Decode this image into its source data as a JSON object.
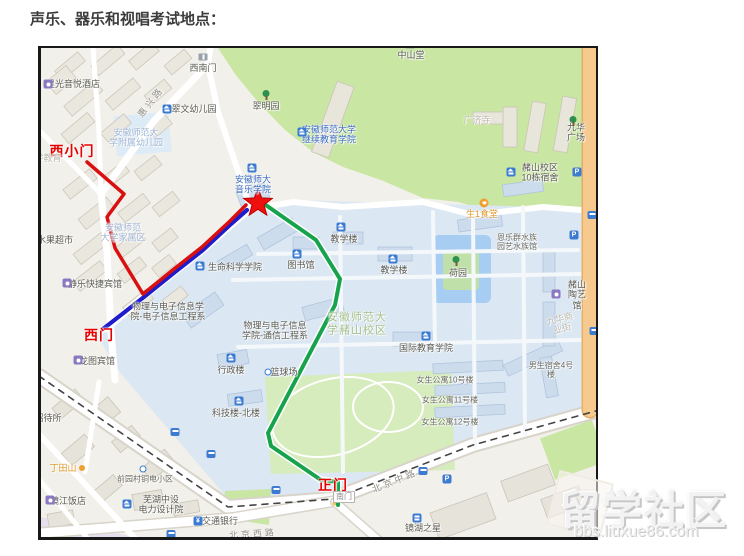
{
  "page": {
    "title": "声乐、器乐和视唱考试地点："
  },
  "watermark": {
    "brand": "留学社区",
    "url": "bbs.liuxue86.com"
  },
  "map": {
    "route_colors": {
      "red": "#da0f0f",
      "blue": "#1f1ccb",
      "green": "#16a34c"
    },
    "star_color": "#ee0f0f",
    "labels": [
      {
        "t": "星光音悦酒店",
        "x": 70,
        "y": 82,
        "c": "poi"
      },
      {
        "t": "西南门",
        "x": 200,
        "y": 66,
        "c": "poi"
      },
      {
        "t": "中山堂",
        "x": 408,
        "y": 53,
        "c": "poi"
      },
      {
        "t": "惠兴路",
        "x": 148,
        "y": 100,
        "c": "road",
        "r": -52
      },
      {
        "t": "翠文幼儿园",
        "x": 191,
        "y": 107,
        "c": "poi"
      },
      {
        "t": "翠明园",
        "x": 263,
        "y": 104,
        "c": "poi"
      },
      {
        "t": "安徽师范大\n学附属幼儿园",
        "x": 133,
        "y": 136,
        "c": "faintblue"
      },
      {
        "t": "西小门",
        "x": 69,
        "y": 149,
        "c": "gate"
      },
      {
        "t": "学教育",
        "x": 45,
        "y": 156,
        "c": "faint"
      },
      {
        "t": "安徽师范大学\n继续教育学院",
        "x": 326,
        "y": 133,
        "c": "blue"
      },
      {
        "t": "广济寺",
        "x": 474,
        "y": 118,
        "c": "faint"
      },
      {
        "t": "九华广场",
        "x": 573,
        "y": 131,
        "c": "poi"
      },
      {
        "t": "安徽师大\n音乐学院",
        "x": 250,
        "y": 183,
        "c": "blue"
      },
      {
        "t": "安徽师范\n大学家属区",
        "x": 120,
        "y": 231,
        "c": "faintblue"
      },
      {
        "t": "水果超市",
        "x": 52,
        "y": 238,
        "c": "poi"
      },
      {
        "t": "生命科学学院",
        "x": 232,
        "y": 265,
        "c": "poi"
      },
      {
        "t": "图书馆",
        "x": 298,
        "y": 263,
        "c": "poi"
      },
      {
        "t": "教学楼",
        "x": 341,
        "y": 237,
        "c": "poi"
      },
      {
        "t": "教学楼",
        "x": 391,
        "y": 268,
        "c": "poi"
      },
      {
        "t": "荷园",
        "x": 455,
        "y": 271,
        "c": "poi"
      },
      {
        "t": "生1食堂",
        "x": 479,
        "y": 212,
        "c": "orange"
      },
      {
        "t": "赭山校区\n10栋宿舍",
        "x": 537,
        "y": 171,
        "c": "poi"
      },
      {
        "t": "恩乐群水族\n园艺水族馆",
        "x": 514,
        "y": 240,
        "c": "poi-small"
      },
      {
        "t": "赭山陶艺馆",
        "x": 574,
        "y": 293,
        "c": "poi"
      },
      {
        "t": "九华商业街",
        "x": 558,
        "y": 322,
        "c": "faint",
        "r": -15
      },
      {
        "t": "静乐快捷宾馆",
        "x": 92,
        "y": 282,
        "c": "poi"
      },
      {
        "t": "物理与电子信息学\n院-电子信息工程系",
        "x": 165,
        "y": 310,
        "c": "poi"
      },
      {
        "t": "物理与电子信息\n学院-通信工程系",
        "x": 272,
        "y": 329,
        "c": "poi"
      },
      {
        "t": "西门",
        "x": 96,
        "y": 333,
        "c": "gate"
      },
      {
        "t": "龙图宾馆",
        "x": 94,
        "y": 359,
        "c": "poi"
      },
      {
        "t": "行政楼",
        "x": 228,
        "y": 368,
        "c": "poi"
      },
      {
        "t": "篮球场",
        "x": 281,
        "y": 370,
        "c": "poi"
      },
      {
        "t": "安徽师范大\n学赭山校区",
        "x": 354,
        "y": 322,
        "c": "faintgreen"
      },
      {
        "t": "国际教育学院",
        "x": 423,
        "y": 346,
        "c": "poi"
      },
      {
        "t": "科技楼-北楼",
        "x": 233,
        "y": 411,
        "c": "poi"
      },
      {
        "t": "女生公寓10号楼",
        "x": 442,
        "y": 378,
        "c": "poi-small"
      },
      {
        "t": "女生公寓11号楼",
        "x": 447,
        "y": 398,
        "c": "poi-small"
      },
      {
        "t": "女生公寓12号楼",
        "x": 447,
        "y": 420,
        "c": "poi-small"
      },
      {
        "t": "男生宿舍4号楼",
        "x": 548,
        "y": 368,
        "c": "poi-small"
      },
      {
        "t": "招待所",
        "x": 45,
        "y": 416,
        "c": "poi"
      },
      {
        "t": "丁田山",
        "x": 60,
        "y": 466,
        "c": "orange"
      },
      {
        "t": "镜江饭店",
        "x": 65,
        "y": 499,
        "c": "poi"
      },
      {
        "t": "前园村铜电小区",
        "x": 142,
        "y": 477,
        "c": "poi-small"
      },
      {
        "t": "芜湖中设\n电力设计院",
        "x": 158,
        "y": 503,
        "c": "poi"
      },
      {
        "t": "交通银行",
        "x": 217,
        "y": 519,
        "c": "poi"
      },
      {
        "t": "北京西路",
        "x": 250,
        "y": 532,
        "c": "road",
        "r": -4
      },
      {
        "t": "正门",
        "x": 330,
        "y": 483,
        "c": "gate"
      },
      {
        "t": "南门",
        "x": 341,
        "y": 495,
        "c": "box"
      },
      {
        "t": "北京中路",
        "x": 392,
        "y": 479,
        "c": "road",
        "r": -22
      },
      {
        "t": "镜湖之星",
        "x": 420,
        "y": 526,
        "c": "poi"
      }
    ],
    "icons": [
      {
        "k": "hotel-icon",
        "x": 45,
        "y": 82
      },
      {
        "k": "gate-icon",
        "x": 200,
        "y": 55
      },
      {
        "k": "gate-icon",
        "x": 407,
        "y": 43
      },
      {
        "k": "school-icon",
        "x": 164,
        "y": 107
      },
      {
        "k": "tree-icon",
        "x": 263,
        "y": 93
      },
      {
        "k": "school-icon",
        "x": 299,
        "y": 130
      },
      {
        "k": "tree-icon",
        "x": 570,
        "y": 119
      },
      {
        "k": "school-icon",
        "x": 249,
        "y": 166
      },
      {
        "k": "school-icon",
        "x": 197,
        "y": 264
      },
      {
        "k": "school-icon",
        "x": 294,
        "y": 252
      },
      {
        "k": "school-icon",
        "x": 338,
        "y": 225
      },
      {
        "k": "school-icon",
        "x": 390,
        "y": 257
      },
      {
        "k": "tree-icon",
        "x": 453,
        "y": 259
      },
      {
        "k": "food-icon",
        "x": 481,
        "y": 201
      },
      {
        "k": "school-icon",
        "x": 508,
        "y": 170
      },
      {
        "k": "hotel-icon",
        "x": 553,
        "y": 292
      },
      {
        "k": "hotel-icon",
        "x": 64,
        "y": 281
      },
      {
        "k": "hotel-icon",
        "x": 75,
        "y": 358
      },
      {
        "k": "school-icon",
        "x": 228,
        "y": 356
      },
      {
        "k": "dot-icon",
        "x": 265,
        "y": 370
      },
      {
        "k": "school-icon",
        "x": 423,
        "y": 334
      },
      {
        "k": "school-icon",
        "x": 236,
        "y": 399
      },
      {
        "k": "orange-dot-icon",
        "x": 79,
        "y": 466
      },
      {
        "k": "hotel-icon",
        "x": 47,
        "y": 498
      },
      {
        "k": "dot-icon",
        "x": 140,
        "y": 467
      },
      {
        "k": "school-icon",
        "x": 124,
        "y": 502
      },
      {
        "k": "bank-icon",
        "x": 195,
        "y": 519
      },
      {
        "k": "building-icon",
        "x": 414,
        "y": 516
      },
      {
        "k": "parking-icon",
        "x": 574,
        "y": 170
      },
      {
        "k": "parking-icon",
        "x": 571,
        "y": 233
      },
      {
        "k": "parking-icon",
        "x": 444,
        "y": 477
      },
      {
        "k": "bus-icon",
        "x": 172,
        "y": 430
      },
      {
        "k": "bus-icon",
        "x": 208,
        "y": 452
      },
      {
        "k": "bus-icon",
        "x": 273,
        "y": 488
      },
      {
        "k": "bus-icon",
        "x": 420,
        "y": 469
      },
      {
        "k": "bus-icon",
        "x": 168,
        "y": 532
      },
      {
        "k": "bus-icon",
        "x": 589,
        "y": 213
      },
      {
        "k": "bus-icon",
        "x": 591,
        "y": 329
      }
    ]
  }
}
